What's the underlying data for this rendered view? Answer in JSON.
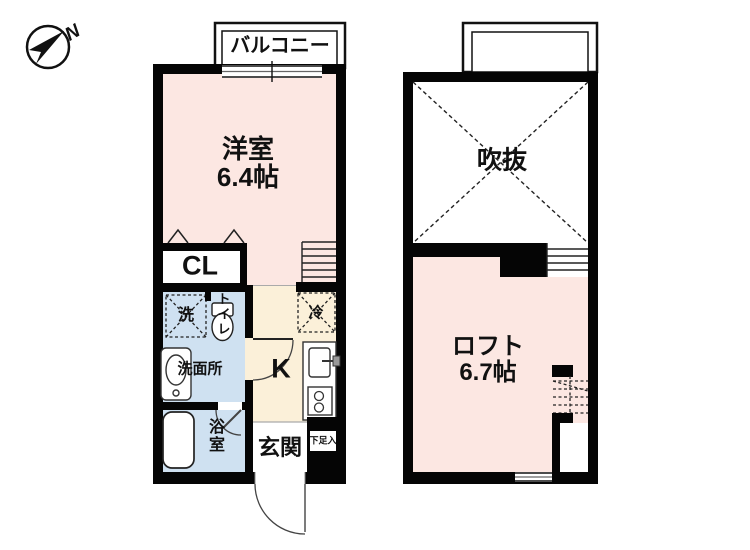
{
  "compass": {
    "label": "N"
  },
  "floor1": {
    "balcony_label": "バルコニー",
    "room_label": "洋室",
    "room_area": "6.4帖",
    "closet_label": "CL",
    "washer_label": "洗",
    "toilet_label": "トイレ",
    "washroom_label": "洗面所",
    "bathroom_label": "浴室",
    "kitchen_label": "K",
    "fridge_label": "冷",
    "entrance_label": "玄関",
    "shoebox_label": "下足入"
  },
  "floor2": {
    "void_label": "吹抜",
    "loft_label": "ロフト",
    "loft_area": "6.7帖"
  },
  "colors": {
    "wall_black": "#050505",
    "room_pink": "#fce7e2",
    "wet_blue": "#cfe1f1",
    "kitchen_cream": "#fbf0d9",
    "line_gray": "#444444"
  }
}
